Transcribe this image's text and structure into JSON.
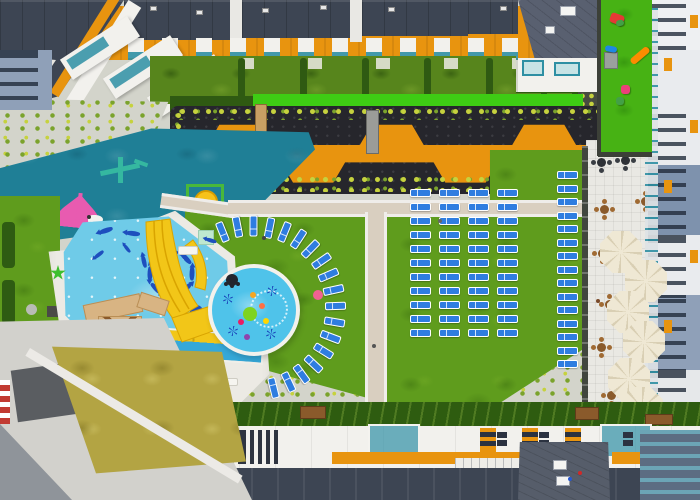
{
  "meta": {
    "title": "Aerial drone view of apartment-complex courtyard with aqua park, splash pad, sun loungers and cafe parasols",
    "type": "aerial-photograph",
    "no_visible_text": true
  },
  "palette": {
    "roof_dark": "#3d4553",
    "orange": "#e8940f",
    "white_terrace": "#f2f1ed",
    "teal_glass": "#2e8fa3",
    "garden_green": "#57851c",
    "hedge_dark": "#2f5a12",
    "turf_bright": "#3ecc14",
    "shrub_yellow": "#c6d23e",
    "shrub_green": "#7ba32c",
    "gravel": "#d3d4cb",
    "lawn": "#5f9c1d",
    "teal_playground": "#1f7f96",
    "pool_blue": "#6fcbe8",
    "deck_white": "#eceae4",
    "slide_yellow": "#f2c618",
    "tan_structure": "#d8b483",
    "navy_decal": "#1e4fbe",
    "funnel_blue": "#1663c7",
    "funnel_dark": "#0b3875",
    "tile_white": "#e9e8e3",
    "parasol_cream": "#efe8d4",
    "parasol_seam": "#d9cfb4",
    "lounger_blue": "#2f7de0",
    "path_beige": "#d9cfc0",
    "path_white": "#efedea",
    "road_gray": "#8f949a",
    "dry_grass": "#b3a443",
    "pink_toy": "#e85bb0",
    "palm_green": "#3dbf2e"
  },
  "scene": {
    "loungers": {
      "arc": {
        "cx": 254,
        "cy": 309,
        "r": 82,
        "start_deg": -112,
        "end_deg": 76,
        "count": 18
      },
      "grid": {
        "x0": 410,
        "y0": 189,
        "cols": 4,
        "rows": 11,
        "dx": 29,
        "dy": 14
      },
      "column": {
        "x": 557,
        "y0": 171,
        "count": 15,
        "dy": 13.5
      }
    },
    "parasols": {
      "cafe_r": 21,
      "cafe": [
        {
          "x": 621,
          "y": 252
        },
        {
          "x": 646,
          "y": 281
        },
        {
          "x": 628,
          "y": 312
        },
        {
          "x": 644,
          "y": 342
        },
        {
          "x": 629,
          "y": 379
        },
        {
          "x": 642,
          "y": 408
        },
        {
          "x": 629,
          "y": 437
        },
        {
          "x": 643,
          "y": 467
        }
      ],
      "pool_r": 9,
      "pool": [
        {
          "x": 150,
          "y": 383
        },
        {
          "x": 170,
          "y": 393
        },
        {
          "x": 187,
          "y": 386
        },
        {
          "x": 162,
          "y": 404
        }
      ]
    },
    "cafe_tables": {
      "dark": [
        {
          "x": 597,
          "y": 158
        },
        {
          "x": 621,
          "y": 156
        }
      ],
      "wood": [
        {
          "x": 600,
          "y": 205
        },
        {
          "x": 641,
          "y": 197
        },
        {
          "x": 598,
          "y": 249
        },
        {
          "x": 605,
          "y": 300
        },
        {
          "x": 597,
          "y": 343
        },
        {
          "x": 607,
          "y": 391
        },
        {
          "x": 597,
          "y": 433
        },
        {
          "x": 607,
          "y": 471
        }
      ]
    },
    "sea_creatures": {
      "fish": [
        {
          "x": 99,
          "y": 228,
          "rot": -20,
          "s": 1
        },
        {
          "x": 126,
          "y": 231,
          "rot": 5,
          "s": 1
        },
        {
          "x": 149,
          "y": 241,
          "rot": 30,
          "s": 1
        },
        {
          "x": 137,
          "y": 259,
          "rot": 75,
          "s": 0.9
        },
        {
          "x": 204,
          "y": 238,
          "rot": 15,
          "s": 0.8
        },
        {
          "x": 92,
          "y": 252,
          "rot": -40,
          "s": 0.8
        },
        {
          "x": 120,
          "y": 246,
          "rot": 50,
          "s": 0.7
        },
        {
          "x": 210,
          "y": 294,
          "rot": 0,
          "s": 0.6
        }
      ],
      "ring": {
        "cx": 171,
        "cy": 273,
        "r": 21,
        "count": 8
      },
      "octopus": {
        "x": 190,
        "y": 305
      }
    },
    "splash_toys": [
      {
        "x": 232,
        "y": 280,
        "type": "octo",
        "color": "#22262e",
        "r": 6
      },
      {
        "x": 250,
        "y": 314,
        "type": "dot",
        "color": "#7ed321",
        "r": 7
      },
      {
        "x": 228,
        "y": 299,
        "type": "snow",
        "color": "",
        "r": 5
      },
      {
        "x": 272,
        "y": 291,
        "type": "snow",
        "color": "",
        "r": 5
      },
      {
        "x": 233,
        "y": 331,
        "type": "snow",
        "color": "",
        "r": 5
      },
      {
        "x": 271,
        "y": 334,
        "type": "snow",
        "color": "",
        "r": 5
      },
      {
        "x": 253,
        "y": 295,
        "type": "dot",
        "color": "#f5a623",
        "r": 3
      },
      {
        "x": 241,
        "y": 322,
        "type": "dot",
        "color": "#e91e63",
        "r": 3
      },
      {
        "x": 262,
        "y": 306,
        "type": "dot",
        "color": "#ff7043",
        "r": 3
      },
      {
        "x": 247,
        "y": 337,
        "type": "dot",
        "color": "#8e44ad",
        "r": 3
      },
      {
        "x": 266,
        "y": 321,
        "type": "dot",
        "color": "#ffd600",
        "r": 3
      },
      {
        "x": 318,
        "y": 295,
        "type": "dot",
        "color": "#f06292",
        "r": 5
      }
    ],
    "kids_toys": [
      {
        "x": 610,
        "y": 14,
        "w": 14,
        "h": 10,
        "rot": 20,
        "color": "#e53935"
      },
      {
        "x": 616,
        "y": 20,
        "w": 8,
        "h": 6,
        "rot": -10,
        "color": "#43a047"
      },
      {
        "x": 629,
        "y": 52,
        "w": 22,
        "h": 7,
        "rot": -40,
        "color": "#fb8c00"
      },
      {
        "x": 605,
        "y": 46,
        "w": 12,
        "h": 6,
        "rot": 10,
        "color": "#1e88e5"
      },
      {
        "x": 621,
        "y": 85,
        "w": 9,
        "h": 9,
        "rot": 0,
        "color": "#ec407a"
      },
      {
        "x": 616,
        "y": 97,
        "w": 8,
        "h": 8,
        "rot": 0,
        "color": "#43a047"
      }
    ],
    "hedge_dividers_x": [
      238,
      300,
      362,
      424,
      486
    ],
    "roof_units": [
      {
        "x": 150,
        "y": 6
      },
      {
        "x": 196,
        "y": 10
      },
      {
        "x": 262,
        "y": 8
      },
      {
        "x": 320,
        "y": 5
      },
      {
        "x": 388,
        "y": 7
      },
      {
        "x": 500,
        "y": 6
      }
    ],
    "louver_groups": [
      {
        "x": 108,
        "n": 6
      },
      {
        "x": 152,
        "n": 6
      },
      {
        "x": 198,
        "n": 6
      },
      {
        "x": 242,
        "n": 5
      }
    ],
    "skylight_pairs_x": [
      497,
      539,
      623,
      665
    ],
    "deck_benches": [
      {
        "x": 178,
        "y": 246,
        "w": 20,
        "h": 9
      },
      {
        "x": 244,
        "y": 290,
        "w": 12,
        "h": 20
      },
      {
        "x": 222,
        "y": 378,
        "w": 16,
        "h": 8
      }
    ],
    "wood_boxes": [
      {
        "x": 300,
        "y": 406,
        "w": 26,
        "h": 13
      },
      {
        "x": 575,
        "y": 407,
        "w": 24,
        "h": 13
      },
      {
        "x": 645,
        "y": 414,
        "w": 28,
        "h": 11
      }
    ],
    "people": [
      {
        "x": 87,
        "y": 215,
        "c": "#333333"
      },
      {
        "x": 262,
        "y": 236,
        "c": "#444444"
      },
      {
        "x": 372,
        "y": 344,
        "c": "#555555"
      },
      {
        "x": 596,
        "y": 299,
        "c": "#7a4a2a"
      },
      {
        "x": 438,
        "y": 219,
        "c": "#666666"
      },
      {
        "x": 578,
        "y": 471,
        "c": "#d02828"
      },
      {
        "x": 568,
        "y": 477,
        "c": "#2858d0"
      }
    ]
  }
}
